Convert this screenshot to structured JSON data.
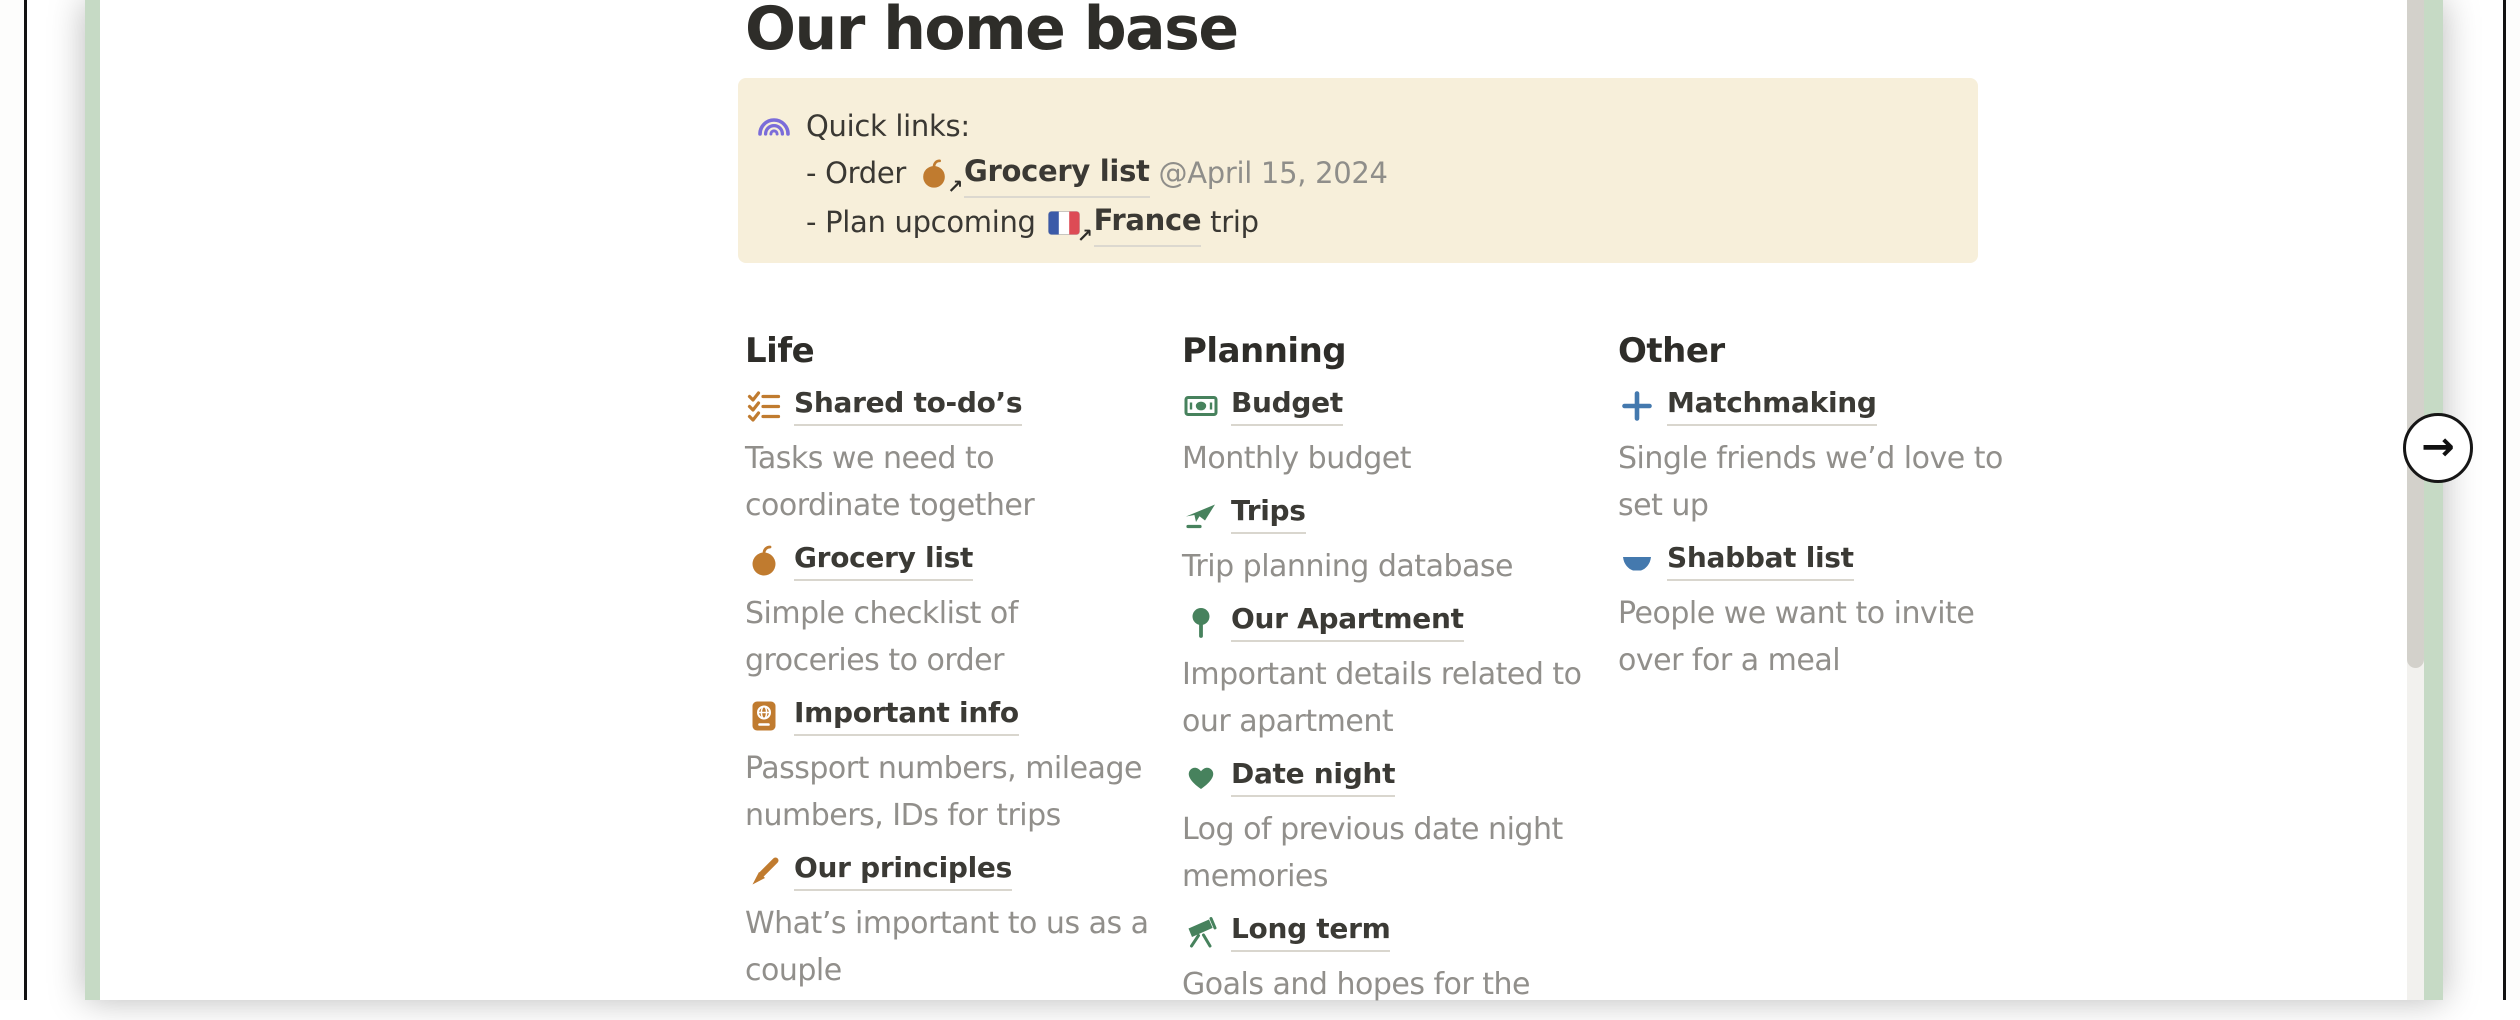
{
  "preview": {
    "title": "Our home base",
    "callout": {
      "heading": "Quick links:",
      "links": [
        {
          "prefix": "- Order",
          "icon": "apple",
          "label": "Grocery list",
          "suffix": "@April 15, 2024"
        },
        {
          "prefix": "- Plan upcoming",
          "icon": "france-flag",
          "label": "France",
          "suffix": "trip"
        }
      ]
    },
    "columns": [
      {
        "header": "Life",
        "items": [
          {
            "icon": "checklist",
            "label": "Shared to-do’s",
            "description": [
              "Tasks we need to",
              "coordinate together"
            ]
          },
          {
            "icon": "apple",
            "label": "Grocery list",
            "description": [
              "Simple checklist of",
              "groceries to order"
            ]
          },
          {
            "icon": "passport",
            "label": "Important info",
            "description": [
              "Passport numbers, mileage",
              "numbers, IDs for trips"
            ]
          },
          {
            "icon": "pen",
            "label": "Our principles",
            "description": [
              "What’s important to us as a",
              "couple"
            ]
          }
        ]
      },
      {
        "header": "Planning",
        "items": [
          {
            "icon": "banknote",
            "label": "Budget",
            "description": [
              "Monthly budget"
            ]
          },
          {
            "icon": "airplane",
            "label": "Trips",
            "description": [
              "Trip planning database"
            ]
          },
          {
            "icon": "round-pin",
            "label": "Our Apartment",
            "description": [
              "Important details related to",
              "our apartment"
            ]
          },
          {
            "icon": "green-heart",
            "label": "Date night",
            "description": [
              "Log of previous date night",
              "memories"
            ]
          },
          {
            "icon": "telescope",
            "label": "Long term",
            "description": [
              "Goals and hopes for the"
            ]
          }
        ]
      },
      {
        "header": "Other",
        "items": [
          {
            "icon": "plus",
            "label": "Matchmaking",
            "description": [
              "Single friends we’d love to",
              "set up"
            ]
          },
          {
            "icon": "bowl",
            "label": "Shabbat list",
            "description": [
              "People we want to invite",
              "over for a meal"
            ]
          }
        ]
      }
    ]
  },
  "carousel": {
    "next_button_glyph": "→",
    "link_out_glyph": "↗"
  },
  "colors": {
    "card_background": "#c6dac5",
    "callout_background": "#f7efda",
    "orange_icon": "#c07b2f",
    "green_icon": "#47825d",
    "blue_icon": "#4479ae",
    "purple_icon": "#7b6cd9",
    "link_text": "#3b3a35",
    "muted_text": "#918f8b",
    "scrollbar_thumb": "#d3d1cb"
  }
}
